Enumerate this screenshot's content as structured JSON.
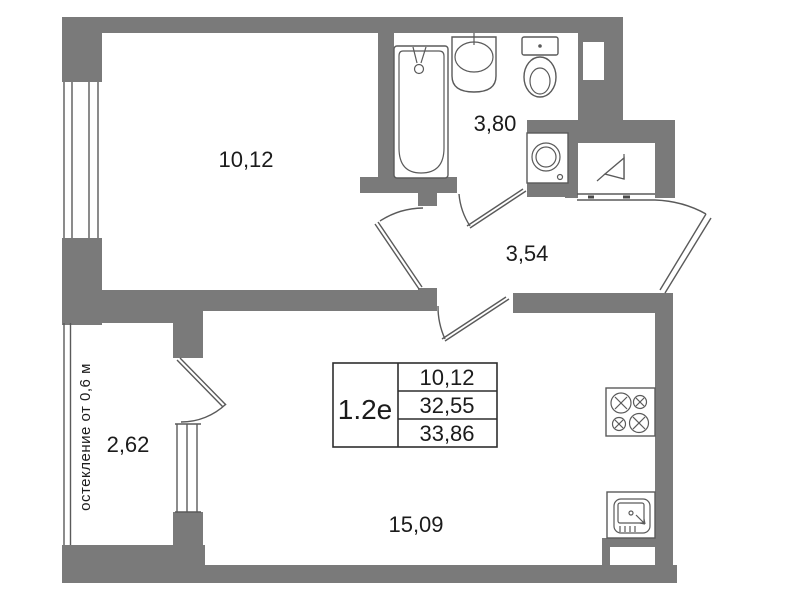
{
  "unit": {
    "code": "1.2е",
    "areas": {
      "row1": "10,12",
      "row2": "32,55",
      "row3": "33,86"
    }
  },
  "rooms": {
    "room": "10,12",
    "bathroom": "3,80",
    "hall": "3,54",
    "balcony": "2,62",
    "living": "15,09"
  },
  "notes": {
    "balcony_glazing": "остекление от 0,6 м"
  },
  "colors": {
    "wall": "#7a7a7a",
    "line": "#5a5a5a",
    "text": "#1b1b1b",
    "background": "#ffffff"
  }
}
